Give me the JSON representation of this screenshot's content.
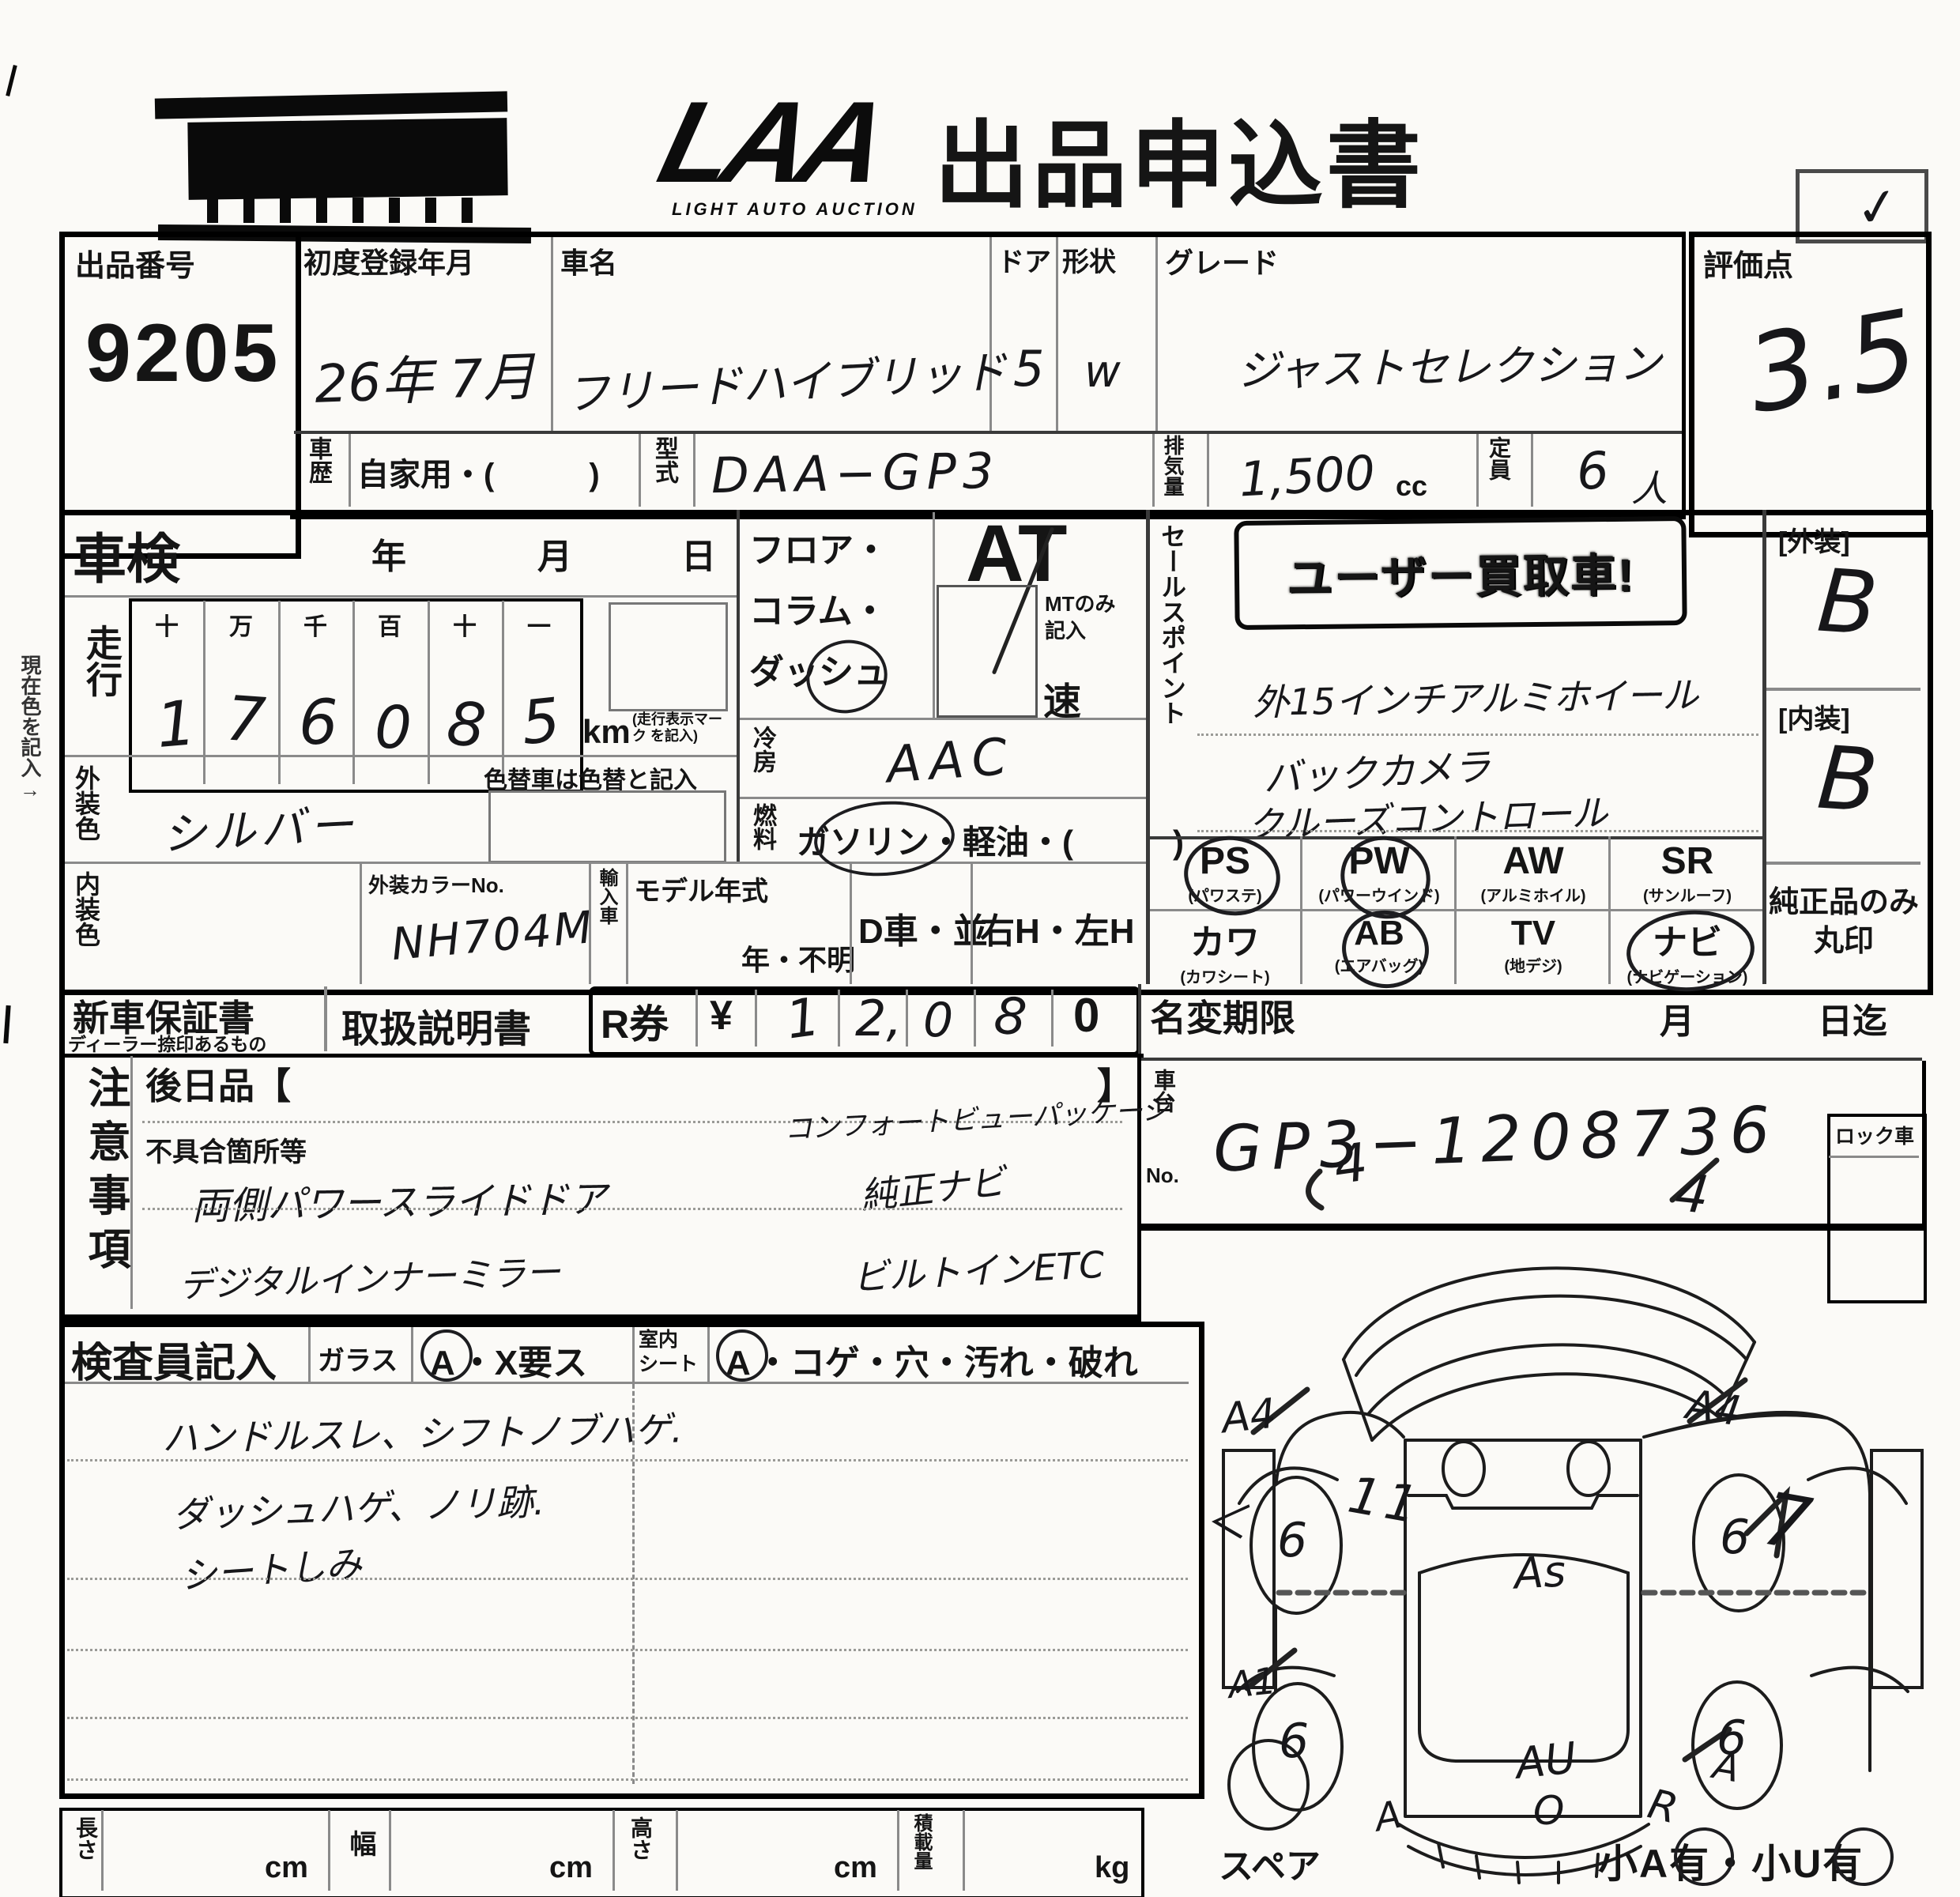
{
  "header": {
    "logo_text": "LAA",
    "logo_subtitle": "LIGHT AUTO AUCTION",
    "title": "出品申込書",
    "check_mark": "✓"
  },
  "top": {
    "auction_no_label": "出品番号",
    "auction_no": "9205",
    "first_reg_label": "初度登録年月",
    "first_reg_value": "26年 7月",
    "car_name_label": "車名",
    "car_name_value": "フリードハイブリッド",
    "doors_label": "ドア",
    "doors_value": "5",
    "shape_label": "形状",
    "shape_value": "W",
    "grade_label": "グレード",
    "grade_value": "ジャストセレクション",
    "score_label": "評価点",
    "score_value": "3.5",
    "history_label": "車歴",
    "history_value": "自家用・(　　　)",
    "model_code_label": "型式",
    "model_code_value": "DAA−GP3",
    "displacement_label": "排気量",
    "displacement_value": "1,500",
    "displacement_unit": "cc",
    "capacity_label": "定員",
    "capacity_value": "6",
    "capacity_unit": "人"
  },
  "shaken": {
    "label": "車検",
    "year_label": "年",
    "month_label": "月",
    "day_label": "日"
  },
  "mileage": {
    "label": "走行",
    "digit_headers": [
      "十",
      "万",
      "千",
      "百",
      "十",
      "一"
    ],
    "digits": [
      "1",
      "7",
      "6",
      "0",
      "8",
      "5"
    ],
    "unit": "km",
    "unit_note": "(走行表示マーク を記入)"
  },
  "left_margin_note": "現在色を記入→",
  "colors": {
    "exterior_label": "外装色",
    "exterior_value": "シルバー",
    "recolor_note": "色替車は色替と記入",
    "interior_label": "内装色",
    "color_no_label": "外装カラーNo.",
    "color_no_value": "NH704M",
    "import_label": "輸入車",
    "model_year_label": "モデル年式",
    "model_year_value": "年・不明",
    "d_car_label": "D車・並",
    "handle_label": "右H・左H"
  },
  "drivetrain": {
    "position_label": "フロア・コラム・ダッシュ",
    "at_label": "AT",
    "mt_note": "MTのみ記入",
    "speed_label": "速",
    "cooling_label": "冷房",
    "cooling_value": "AAC",
    "fuel_label": "燃料",
    "fuel_value_circled": "ガソリン",
    "fuel_value_rest": "・軽油・(　　　)"
  },
  "sales_point": {
    "label": "セールスポイント",
    "stamp_text": "ユーザー買取車!",
    "lines": [
      "外15インチアルミホイール",
      "バックカメラ",
      "クルーズコントロール"
    ]
  },
  "grades": {
    "exterior_label": "[外装]",
    "exterior_value": "B",
    "interior_label": "[内装]",
    "interior_value": "B"
  },
  "equipment": {
    "items": [
      {
        "code": "PS",
        "name": "(パワステ)"
      },
      {
        "code": "PW",
        "name": "(パワーウインド)"
      },
      {
        "code": "AW",
        "name": "(アルミホイル)"
      },
      {
        "code": "SR",
        "name": "(サンルーフ)"
      },
      {
        "code": "カワ",
        "name": "(カワシート)"
      },
      {
        "code": "AB",
        "name": "(エアバッグ)"
      },
      {
        "code": "TV",
        "name": "(地デジ)"
      },
      {
        "code": "ナビ",
        "name": "(ナビゲーション)"
      }
    ],
    "genuine_note_line1": "純正品のみ",
    "genuine_note_line2": "丸印"
  },
  "documents": {
    "warranty_label": "新車保証書",
    "warranty_sub": "ディーラー捺印あるもの",
    "manual_label": "取扱説明書",
    "r_ticket_label": "R券",
    "currency": "¥",
    "amount_digits": [
      "1",
      "2,",
      "0",
      "8"
    ],
    "amount_printed_zero": "0",
    "name_change_label": "名変期限",
    "name_change_month": "月",
    "name_change_until": "日迄"
  },
  "chassis": {
    "label_line1": "車台",
    "label_line2": "No.",
    "value": "GP3−1208736"
  },
  "attention": {
    "label": "注意事項",
    "later_label": "後日品【",
    "later_close": "】",
    "defect_label": "不具合箇所等",
    "hw_left": [
      "両側パワースライドドア",
      "デジタルインナーミラー"
    ],
    "hw_right": [
      "コンフォートビューパッケージ",
      "純正ナビ",
      "ビルトインETC"
    ]
  },
  "lock_label": "ロック車",
  "inspector": {
    "label": "検査員記入",
    "glass_label": "ガラス",
    "glass_code_a": "A",
    "glass_code_rest": "・X要ス",
    "seat_label_line1": "室内",
    "seat_label_line2": "シート",
    "seat_code_a": "A",
    "seat_code_rest": "・コゲ・穴・汚れ・破れ",
    "notes": [
      "ハンドルスレ、シフトノブハゲ.",
      "ダッシュハゲ、ノリ跡.",
      "シートしみ"
    ]
  },
  "measurements": {
    "length_label": "長さ",
    "width_label": "幅",
    "height_label": "高さ",
    "load_label": "積載量",
    "cm": "cm",
    "kg": "kg"
  },
  "diagram": {
    "spare_label": "スペア",
    "corner_note": "小A有・小U有",
    "marks": [
      {
        "text": "4"
      },
      {
        "text": "4"
      },
      {
        "text": "A4"
      },
      {
        "text": "A4"
      },
      {
        "text": "6"
      },
      {
        "text": "6"
      },
      {
        "text": "6"
      },
      {
        "text": "6"
      },
      {
        "text": "11"
      },
      {
        "text": "＜"
      },
      {
        "text": "As"
      },
      {
        "text": "7"
      },
      {
        "text": "A1"
      },
      {
        "text": "A"
      },
      {
        "text": "AU"
      },
      {
        "text": "O"
      },
      {
        "text": "A"
      },
      {
        "text": "R"
      }
    ]
  }
}
